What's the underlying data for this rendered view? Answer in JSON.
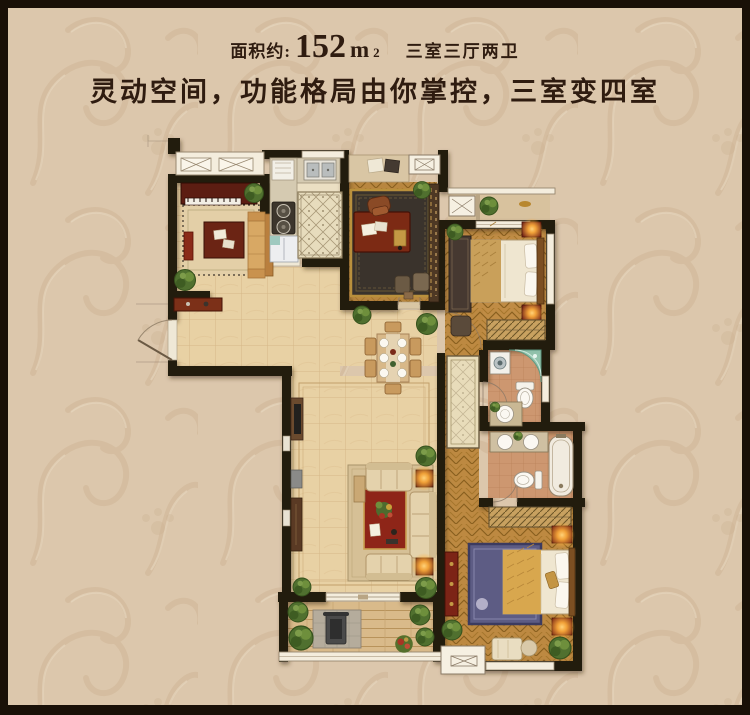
{
  "header": {
    "area_label": "面积约:",
    "area_value": "152",
    "area_unit": "m",
    "area_unit_sup": "2",
    "layout_text": "三室三厅两卫",
    "slogan": "灵动空间，功能格局由你掌控，三室变四室"
  },
  "colors": {
    "page_background": "#dcc7ac",
    "frame": "#191007",
    "title_text": "#2f1c10",
    "wall": "#241a10",
    "window_white": "#f4eddd",
    "marble_floor": "#e8d1a4",
    "wood_floor": "#b8863f",
    "bathroom_tile": "#cd9770",
    "rug_red": "#8e2518",
    "rug_blue": "#5d5c84",
    "lamp_glow": "#ffaf3c",
    "plant_green": "#50702f",
    "shower_glass": "#8fc7b2"
  }
}
